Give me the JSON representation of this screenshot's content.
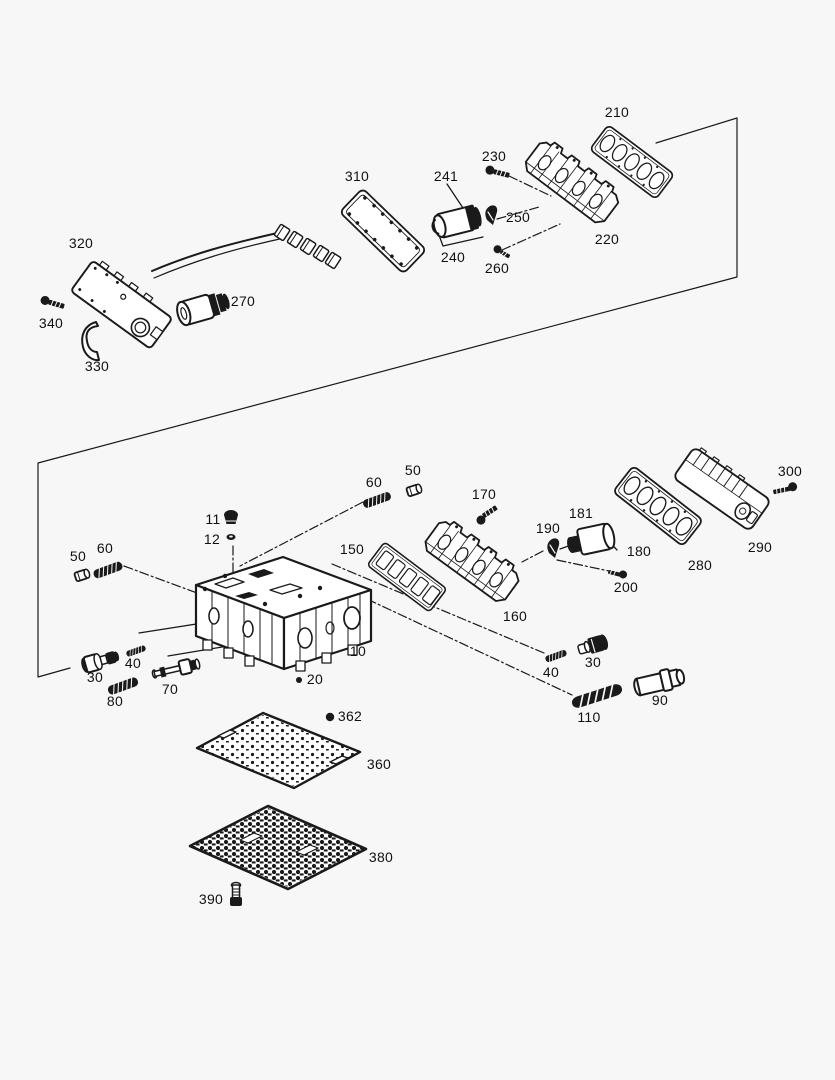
{
  "meta": {
    "colors": {
      "background": "#f7f7f7",
      "line": "#1a1a1a",
      "label": "#111111"
    },
    "label_font_size_px": 14
  },
  "diagram": {
    "type": "exploded-parts-diagram",
    "callouts": [
      {
        "id": "210",
        "label": "210",
        "x": 617,
        "y": 112
      },
      {
        "id": "230",
        "label": "230",
        "x": 494,
        "y": 156
      },
      {
        "id": "241",
        "label": "241",
        "x": 446,
        "y": 176
      },
      {
        "id": "310",
        "label": "310",
        "x": 357,
        "y": 176
      },
      {
        "id": "250",
        "label": "250",
        "x": 518,
        "y": 217
      },
      {
        "id": "220",
        "label": "220",
        "x": 607,
        "y": 239
      },
      {
        "id": "240",
        "label": "240",
        "x": 453,
        "y": 257
      },
      {
        "id": "260",
        "label": "260",
        "x": 497,
        "y": 268
      },
      {
        "id": "320",
        "label": "320",
        "x": 81,
        "y": 243
      },
      {
        "id": "270",
        "label": "270",
        "x": 243,
        "y": 301
      },
      {
        "id": "340",
        "label": "340",
        "x": 51,
        "y": 323
      },
      {
        "id": "330",
        "label": "330",
        "x": 97,
        "y": 366
      },
      {
        "id": "300",
        "label": "300",
        "x": 790,
        "y": 471
      },
      {
        "id": "290",
        "label": "290",
        "x": 760,
        "y": 547
      },
      {
        "id": "280",
        "label": "280",
        "x": 700,
        "y": 565
      },
      {
        "id": "170",
        "label": "170",
        "x": 484,
        "y": 494
      },
      {
        "id": "181",
        "label": "181",
        "x": 581,
        "y": 513
      },
      {
        "id": "190",
        "label": "190",
        "x": 548,
        "y": 528
      },
      {
        "id": "180",
        "label": "180",
        "x": 639,
        "y": 551
      },
      {
        "id": "200",
        "label": "200",
        "x": 626,
        "y": 587
      },
      {
        "id": "160",
        "label": "160",
        "x": 515,
        "y": 616
      },
      {
        "id": "150",
        "label": "150",
        "x": 352,
        "y": 549
      },
      {
        "id": "50-right",
        "label": "50",
        "x": 413,
        "y": 470
      },
      {
        "id": "60-right",
        "label": "60",
        "x": 374,
        "y": 482
      },
      {
        "id": "11",
        "label": "11",
        "x": 213,
        "y": 519
      },
      {
        "id": "12",
        "label": "12",
        "x": 212,
        "y": 539
      },
      {
        "id": "50-left",
        "label": "50",
        "x": 78,
        "y": 556
      },
      {
        "id": "60-left",
        "label": "60",
        "x": 105,
        "y": 548
      },
      {
        "id": "10",
        "label": "10",
        "x": 358,
        "y": 651
      },
      {
        "id": "30-left",
        "label": "30",
        "x": 95,
        "y": 677
      },
      {
        "id": "40-left",
        "label": "40",
        "x": 133,
        "y": 663
      },
      {
        "id": "70",
        "label": "70",
        "x": 170,
        "y": 689
      },
      {
        "id": "80",
        "label": "80",
        "x": 115,
        "y": 701
      },
      {
        "id": "20",
        "label": "20",
        "x": 315,
        "y": 679
      },
      {
        "id": "40-right",
        "label": "40",
        "x": 551,
        "y": 672
      },
      {
        "id": "30-right",
        "label": "30",
        "x": 593,
        "y": 662
      },
      {
        "id": "110",
        "label": "110",
        "x": 589,
        "y": 717
      },
      {
        "id": "90",
        "label": "90",
        "x": 660,
        "y": 700
      },
      {
        "id": "362",
        "label": "362",
        "x": 350,
        "y": 716
      },
      {
        "id": "360",
        "label": "360",
        "x": 379,
        "y": 764
      },
      {
        "id": "380",
        "label": "380",
        "x": 381,
        "y": 857
      },
      {
        "id": "390",
        "label": "390",
        "x": 211,
        "y": 899
      }
    ]
  }
}
